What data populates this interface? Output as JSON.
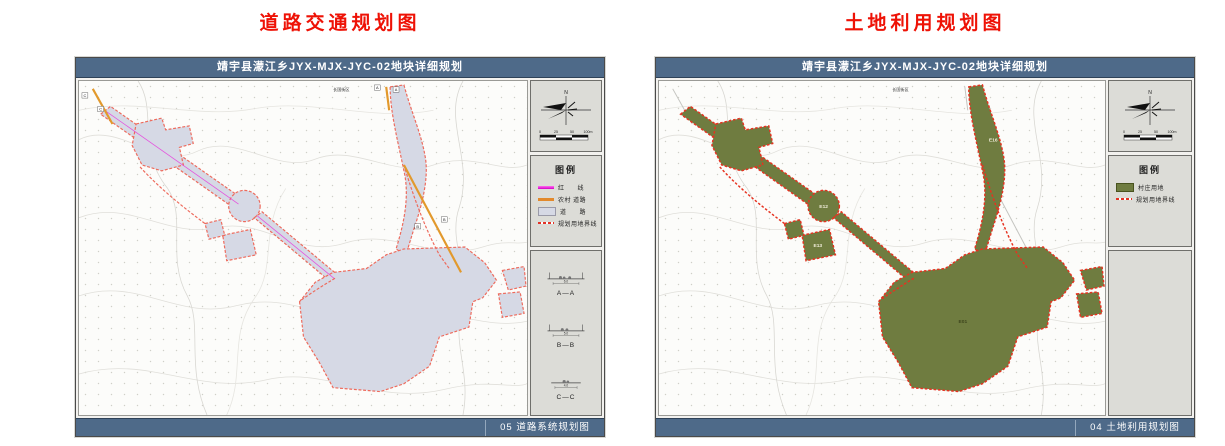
{
  "page_titles": {
    "left": "道路交通规划图",
    "right": "土地利用规划图"
  },
  "colors": {
    "title_red": "#ee1206",
    "titlebar_blue": "#4e6a89",
    "road_plot_fill": "#d6d9e5",
    "road_plot_outline": "#ee6a5c",
    "landuse_plot_fill": "#6f7c40",
    "landuse_plot_outline": "#e63220",
    "road_line_magenta": "#e832dc",
    "road_line_orange": "#e2892c"
  },
  "left": {
    "header": "靖宇县濛江乡JYX-MJX-JYC-02地块详细规划",
    "footer": "05 道路系统规划图",
    "north": "N",
    "scale_ticks": [
      "0",
      "25",
      "50",
      "100m"
    ],
    "street_label": "长国街区",
    "markers": {
      "a": "A",
      "b": "B",
      "c": "C"
    },
    "legend": {
      "title": "图例",
      "items": [
        {
          "label": "红　　线",
          "swatch": "magenta-line-icon"
        },
        {
          "label": "农村 道路",
          "swatch": "orange-line-icon"
        },
        {
          "label": "道　　路",
          "swatch": "gray-fill-icon"
        },
        {
          "label": "规划用地界线",
          "swatch": "red-dash-icon"
        }
      ]
    },
    "sections": [
      {
        "label": "A—A",
        "dim": "6.0"
      },
      {
        "label": "B—B",
        "dim": "5.0"
      },
      {
        "label": "C—C",
        "dim": "4.0"
      }
    ]
  },
  "right": {
    "header": "靖宇县濛江乡JYX-MJX-JYC-02地块详细规划",
    "footer": "04 土地利用规划图",
    "north": "N",
    "scale_ticks": [
      "0",
      "25",
      "50",
      "100m"
    ],
    "street_label": "长国街区",
    "legend": {
      "title": "图例",
      "items": [
        {
          "label": "村庄用地",
          "swatch": "green-fill-icon"
        },
        {
          "label": "规划用地界线",
          "swatch": "red-dash-icon"
        }
      ]
    },
    "plot_labels": [
      {
        "text": "E16"
      },
      {
        "text": "E12"
      },
      {
        "text": "E13"
      },
      {
        "text": "E01"
      }
    ]
  }
}
